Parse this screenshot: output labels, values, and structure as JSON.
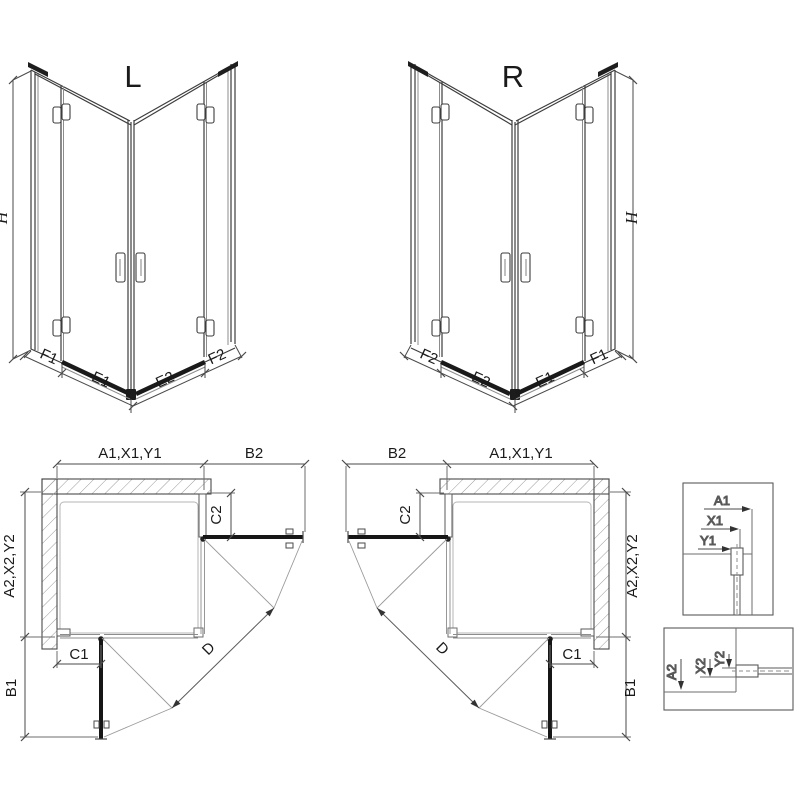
{
  "views": {
    "perspective_left": {
      "variant": "L",
      "height_dim": "H",
      "bottom_dims": [
        "F1",
        "E1",
        "E2",
        "F2"
      ]
    },
    "perspective_right": {
      "variant": "R",
      "height_dim": "H",
      "bottom_dims": [
        "F2",
        "E2",
        "E1",
        "F1"
      ]
    },
    "plan_left": {
      "overall_width": "A1,X1,Y1",
      "door_projection_side": "B2",
      "fixed_segment_side": "C2",
      "overall_depth": "A2,X2,Y2",
      "fixed_segment_front": "C1",
      "door_projection_front": "B1",
      "diagonal_entry": "D"
    },
    "plan_right": {
      "overall_width": "A1,X1,Y1",
      "door_projection_side": "B2",
      "fixed_segment_side": "C2",
      "overall_depth": "A2,X2,Y2",
      "fixed_segment_front": "C1",
      "door_projection_front": "B1",
      "diagonal_entry": "D"
    },
    "detail_top": {
      "dims": [
        "A1",
        "X1",
        "Y1"
      ]
    },
    "detail_bottom": {
      "dims": [
        "A2",
        "X2",
        "Y2"
      ]
    }
  },
  "colors": {
    "line": "#3d3d3d",
    "dark": "#1b1b1b",
    "dimension": "#4a4a4a",
    "background": "#ffffff"
  }
}
